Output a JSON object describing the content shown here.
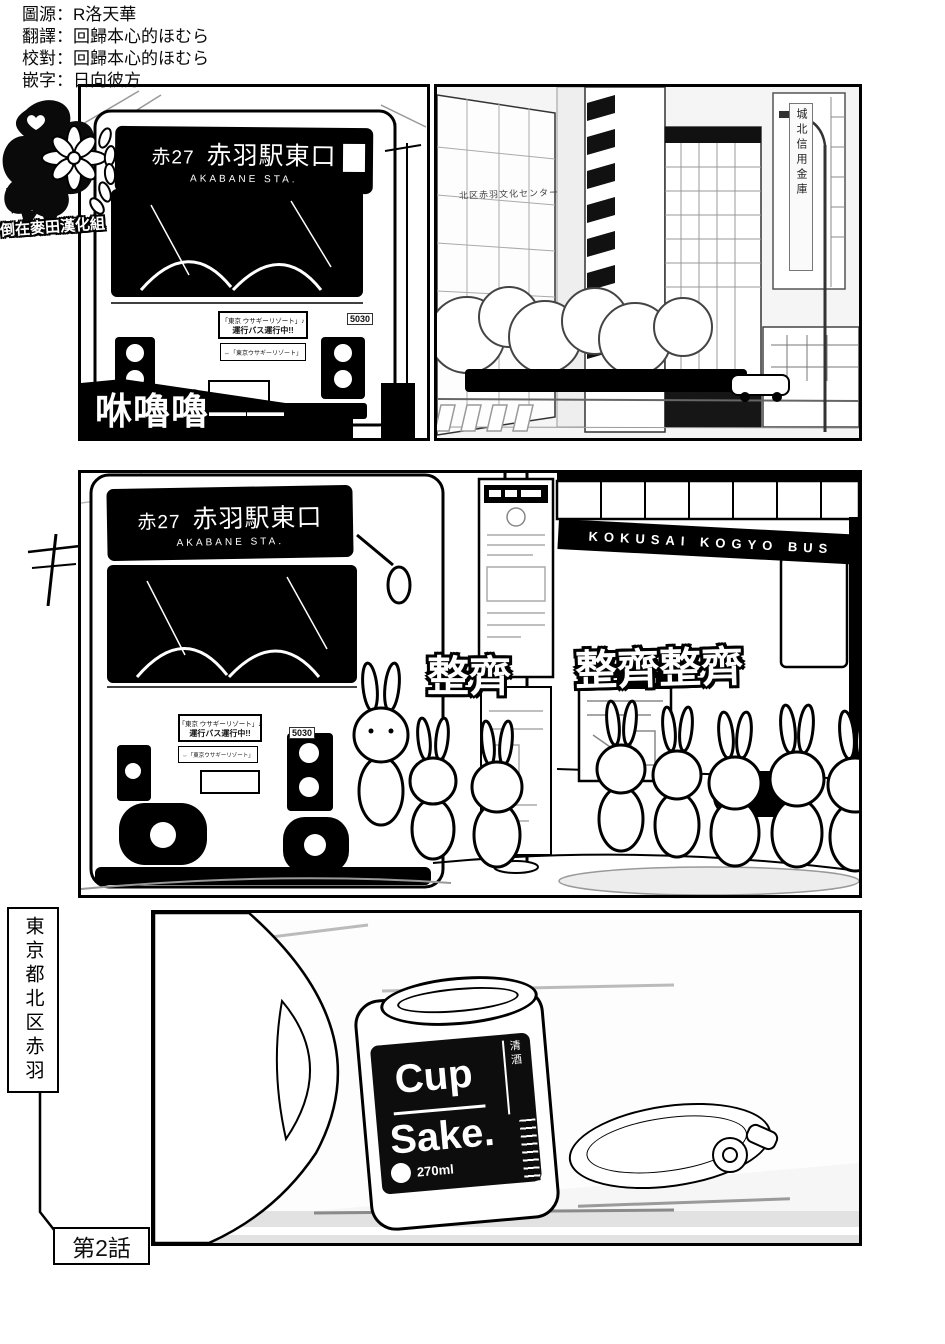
{
  "credits": {
    "lines": [
      "圖源：R洛天華",
      "翻譯：回歸本心的ほむら",
      "校對：回歸本心的ほむら",
      "嵌字：日向彼方"
    ]
  },
  "logo": {
    "group_name": "倒在麥田漢化組"
  },
  "panel_bus_front": {
    "destination_sign": {
      "route": "赤27",
      "destination": "赤羽駅東口",
      "destination_en": "AKABANE STA."
    },
    "banner": {
      "line1": "「東京 ウサギーリゾート」♪",
      "line2": "運行バス運行中!!"
    },
    "route_plate": "⇔「東京ウサギーリゾート」",
    "bus_number": "5030",
    "sfx_rumble": "咻嚕嚕——"
  },
  "panel_street": {
    "culture_center_sign": "北区赤羽文化センター",
    "bank_sign": "城北信用金庫"
  },
  "panel_bus_stop": {
    "destination_sign": {
      "route": "赤27",
      "destination": "赤羽駅東口",
      "destination_en": "AKABANE STA."
    },
    "bus_side_text": "KOKUSAI KOGYO BUS",
    "banner": {
      "line1": "「東京 ウサギーリゾート」♪",
      "line2": "運行バス運行中!!"
    },
    "route_plate": "⇔「東京ウサギーリゾート」",
    "bus_number": "5030",
    "sfx_neat_1": "整齊",
    "sfx_neat_2": "整齊整齊"
  },
  "panel_cup_sake": {
    "location_caption": "東京都北区赤羽",
    "chapter_label": "第2話",
    "can": {
      "brand_top": "Cup",
      "brand_bottom": "Sake.",
      "type_vertical": "清酒",
      "volume": "270ml"
    }
  }
}
